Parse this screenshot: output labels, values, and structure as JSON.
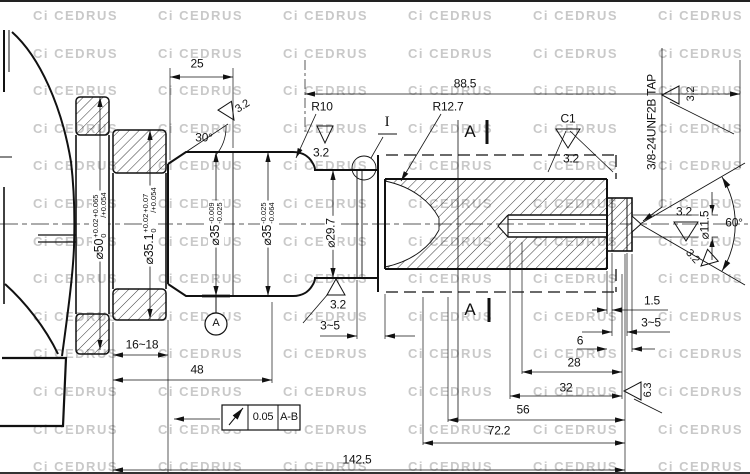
{
  "watermark": {
    "mark": "Ci",
    "brand": "CEDRUS",
    "color": "#c9c9c9"
  },
  "dims": {
    "d25": "25",
    "d88_5": "88.5",
    "d30": "30°",
    "r10": "R10",
    "r12_7": "R12.7",
    "c1": "C1",
    "detail": "I",
    "tap": "3/8-24UNF2B TAP",
    "deg60": "60°",
    "d1_5": "1.5",
    "d3_5": "3~5",
    "d6": "6",
    "d28": "28",
    "d32": "32",
    "d56": "56",
    "d72_2": "72.2",
    "d142_5": "142.5",
    "d16_18": "16~18",
    "d48": "48",
    "d29_7": "⌀29.7",
    "d11_5": "⌀11.5"
  },
  "finish": {
    "f32": "3.2",
    "f63": "6.3"
  },
  "datum": {
    "a": "A"
  },
  "section": {
    "a": "A"
  },
  "fcf": {
    "tol": "0.05",
    "datums": "A-B"
  },
  "dia": {
    "d50": {
      "main": "⌀50",
      "t1top": "+0.02",
      "t1bot": "0",
      "t2top": "+0.065",
      "t2bot": "/+0.054"
    },
    "d35_1": {
      "main": "⌀35.1",
      "t1top": "+0.02",
      "t1bot": "0",
      "t2top": "+0.07",
      "t2bot": "/+0.054"
    },
    "d35a": {
      "main": "⌀35",
      "t1top": "-0.009",
      "t1bot": "-0.025"
    },
    "d35b": {
      "main": "⌀35",
      "t1top": "-0.025",
      "t1bot": "-0.064"
    }
  }
}
